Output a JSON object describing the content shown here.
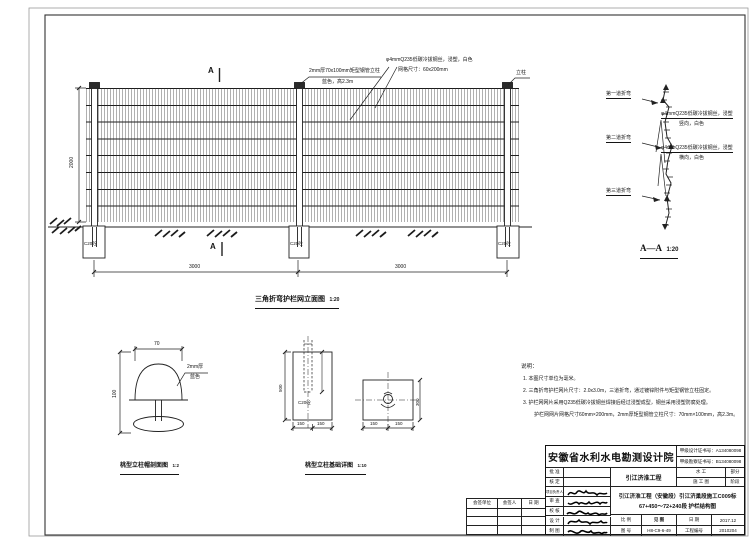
{
  "elevation": {
    "caption": "三角折弯护栏网立面图",
    "scale": "1:20",
    "section_letter": "A",
    "post_note_1": "2mm厚70x100mm矩型钢管立柱",
    "post_note_2": "蓝色，高2.3m",
    "mesh_note_1": "φ4mmQ235低碳冷拔钢丝，浸塑，白色",
    "mesh_note_2": "网格尺寸：60x200mm",
    "post_label": "立柱",
    "footing_label": "C20砼",
    "dim_height": "2000",
    "dim_span_1": "3000",
    "dim_span_2": "3000"
  },
  "section_aa": {
    "caption": "A—A",
    "scale": "1:20",
    "bend_1": "第一道折弯",
    "bend_2": "第二道折弯",
    "bend_3": "第三道折弯",
    "wire_v_1": "φ4mmQ235低碳冷拔钢丝，浸塑",
    "wire_v_2": "竖向，白色",
    "wire_h_1": "φ4mmQ235低碳冷拔钢丝，浸塑",
    "wire_h_2": "横向，白色"
  },
  "detail_cap": {
    "caption": "桃型立柱帽剖面图",
    "scale": "1:2",
    "dim_width": "70",
    "dim_height": "100",
    "note_1": "2mm厚",
    "note_2": "蓝色"
  },
  "detail_foundation": {
    "caption": "桃型立柱基础详图",
    "scale": "1:10",
    "concrete_label": "C20砼",
    "dim_depth": "500",
    "dim_side": "300",
    "dim_seg": "150"
  },
  "notes": {
    "title": "说明：",
    "item_1": "1. 本图尺寸单位为毫米。",
    "item_2": "2. 三角折弯护栏网片尺寸：2.0x3.0m，三道折弯，通过镀锌附件与矩型钢管立柱固定。",
    "item_3": "3. 护栏网网片采用Q235低碳冷拔钢丝焊接后经过浸塑成型，钢丝采用浸塑防腐处理。",
    "item_3b": "护栏网网片网格尺寸60mm×200mm，2mm厚矩型钢管立柱尺寸：70mm×100mm，高2.3m。"
  },
  "countersign": {
    "col_unit": "会签单位",
    "col_person": "会签人",
    "col_date": "日 期"
  },
  "titleblock": {
    "institute": "安徽省水利水电勘测设计院",
    "cert_design": "甲级设计证书号：A134080098",
    "cert_survey": "甲级勘察证书号：B134080098",
    "project": "引江济淮工程",
    "discipline_value": "水  工",
    "discipline_label": "部分",
    "phase_value": "施 工 图",
    "phase_label": "阶段",
    "role_1": "批 准",
    "role_2": "核 定",
    "role_3": "项目负责人",
    "role_4": "审 查",
    "role_5": "校 核",
    "role_6": "设 计",
    "role_7": "制 图",
    "drawing_title_1": "引江济淮工程（安徽段）引江济巢段施工C009标",
    "drawing_title_2": "67+450～72+240段 护栏结构图",
    "scale_label": "比 例",
    "scale_value": "见 图",
    "date_label": "日 期",
    "date_value": "2017.12",
    "figno_label": "图 号",
    "figno_value": "H8-C9-6-49",
    "projno_label": "工程编号",
    "projno_value": "2010204"
  }
}
